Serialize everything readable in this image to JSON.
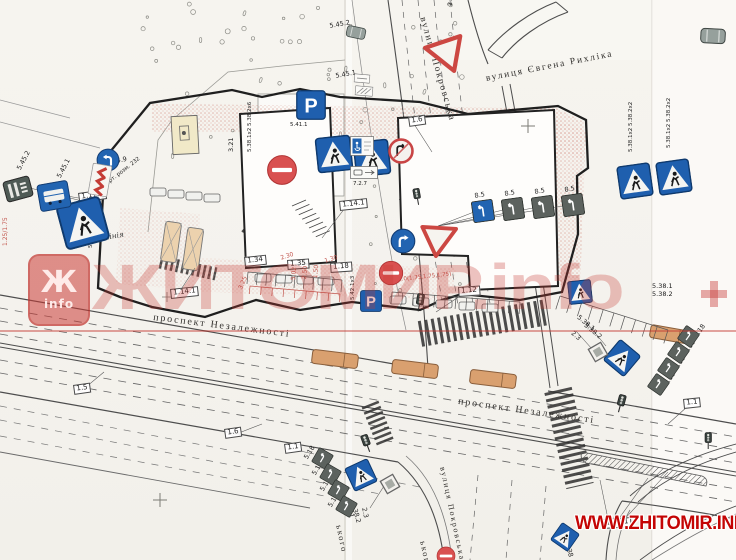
{
  "colors": {
    "paper": "#f5f3ee",
    "line": "#4d4d4d",
    "sign_blue": "#1f5fae",
    "sign_red": "#d95050",
    "bus_orange": "#d9a06f",
    "hatch_pink": "#dba49b",
    "watermark_red": "#c63a34",
    "url_red": "#c40404"
  },
  "watermark": {
    "logo_letter": "Ж",
    "logo_sub": "info",
    "big_text": "ЖИТОМИР.info",
    "url_text": "WWW.ZHITOMIR.INFO"
  },
  "signs_config": {
    "parking_letter": "P"
  },
  "streets": [
    {
      "t": "проспект Незалежності",
      "x": 154,
      "y": 312,
      "r": 7,
      "fs": 10
    },
    {
      "t": "проспект Незалежності",
      "x": 459,
      "y": 396,
      "r": 8,
      "fs": 10
    },
    {
      "t": "вулиця Покровська",
      "x": 427,
      "y": 16,
      "r": 74,
      "fs": 9.5
    },
    {
      "t": "вулиця Покровська",
      "x": 447,
      "y": 466,
      "r": 78,
      "fs": 8
    },
    {
      "t": "вулиця Євгена Рихліка",
      "x": 485,
      "y": 74,
      "r": -11,
      "fs": 9.5
    },
    {
      "t": "ького",
      "x": 344,
      "y": 524,
      "r": 78,
      "fs": 8.5
    },
    {
      "t": "ького",
      "x": 428,
      "y": 540,
      "r": 78,
      "fs": 8.5
    }
  ],
  "labels": [
    {
      "t": "1.17.1",
      "x": 78,
      "y": 193,
      "r": -8,
      "c": "box"
    },
    {
      "t": "5.45.2",
      "x": 16,
      "y": 168,
      "r": -62
    },
    {
      "t": "5.45.1",
      "x": 56,
      "y": 176,
      "r": -62
    },
    {
      "t": "4.9",
      "x": 116,
      "y": 158,
      "r": -12
    },
    {
      "t": "Верт. розм. 232",
      "x": 102,
      "y": 184,
      "r": -38,
      "fs": 5.5
    },
    {
      "t": "5.38.1х2 5.38.2х2",
      "x": 88,
      "y": 248,
      "r": -90,
      "fs": 5.5
    },
    {
      "t": "червона лінія",
      "x": 70,
      "y": 240,
      "r": -10,
      "c": "script"
    },
    {
      "t": "3.21",
      "x": 228,
      "y": 152,
      "r": -90
    },
    {
      "t": "5.38.1х2 5.38.2х6",
      "x": 247,
      "y": 152,
      "r": -90,
      "fs": 5.5
    },
    {
      "t": "5.41.1",
      "x": 290,
      "y": 122,
      "r": 0,
      "fs": 5.5
    },
    {
      "t": "7.17",
      "x": 355,
      "y": 158,
      "r": 0,
      "fs": 5.5
    },
    {
      "t": "7.2.7",
      "x": 353,
      "y": 181,
      "r": 0,
      "fs": 5.5
    },
    {
      "t": "1.6",
      "x": 408,
      "y": 117,
      "r": -8,
      "c": "box"
    },
    {
      "t": "2.1",
      "x": 447,
      "y": 6,
      "r": -90
    },
    {
      "t": "1.34",
      "x": 244,
      "y": 257,
      "r": -6,
      "c": "box"
    },
    {
      "t": "1.35",
      "x": 287,
      "y": 260,
      "r": -4,
      "c": "box"
    },
    {
      "t": "1.18",
      "x": 330,
      "y": 263,
      "r": -4,
      "c": "box"
    },
    {
      "t": "1.14.1",
      "x": 170,
      "y": 289,
      "r": -6,
      "c": "box"
    },
    {
      "t": "1.14.1",
      "x": 339,
      "y": 201,
      "r": -6,
      "c": "box"
    },
    {
      "t": "1.12",
      "x": 458,
      "y": 287,
      "r": -4,
      "c": "box"
    },
    {
      "t": "2.1",
      "x": 404,
      "y": 244,
      "r": -80
    },
    {
      "t": "1.0(1.75,1.75,1.75)",
      "x": 398,
      "y": 277,
      "r": -6,
      "c": "red",
      "fs": 5.5
    },
    {
      "t": "5.02",
      "x": 291,
      "y": 280,
      "r": -85,
      "c": "red"
    },
    {
      "t": "2.50",
      "x": 302,
      "y": 279,
      "r": -85,
      "c": "red"
    },
    {
      "t": "1.50",
      "x": 313,
      "y": 278,
      "r": -85,
      "c": "red"
    },
    {
      "t": "2.30",
      "x": 280,
      "y": 256,
      "r": -18,
      "c": "red"
    },
    {
      "t": "1.30",
      "x": 324,
      "y": 259,
      "r": -18,
      "c": "red"
    },
    {
      "t": "3.25",
      "x": 238,
      "y": 288,
      "r": -65,
      "c": "red"
    },
    {
      "t": "1.25/1.75",
      "x": 3,
      "y": 246,
      "r": -90,
      "c": "red"
    },
    {
      "t": "5.42.1х3",
      "x": 350,
      "y": 300,
      "r": -90,
      "fs": 5.5
    },
    {
      "t": "8.5",
      "x": 474,
      "y": 193,
      "r": -10
    },
    {
      "t": "8.5",
      "x": 504,
      "y": 191,
      "r": -10
    },
    {
      "t": "8.5",
      "x": 534,
      "y": 189,
      "r": -10
    },
    {
      "t": "8.5",
      "x": 564,
      "y": 187,
      "r": -10
    },
    {
      "t": "5.38.1х2 5.38.2х2",
      "x": 628,
      "y": 152,
      "r": -90,
      "fs": 5.5
    },
    {
      "t": "5.38.1х2 5.38.2х2",
      "x": 666,
      "y": 148,
      "r": -90,
      "fs": 5.5
    },
    {
      "t": "5.38.1",
      "x": 652,
      "y": 283,
      "r": 0
    },
    {
      "t": "5.38.2",
      "x": 652,
      "y": 291,
      "r": 0
    },
    {
      "t": "2.3",
      "x": 574,
      "y": 330,
      "r": 40
    },
    {
      "t": "5.38.1",
      "x": 580,
      "y": 314,
      "r": 40
    },
    {
      "t": "5.38.2",
      "x": 587,
      "y": 322,
      "r": 40
    },
    {
      "t": "5.18",
      "x": 303,
      "y": 457,
      "r": -58
    },
    {
      "t": "5.18",
      "x": 311,
      "y": 473,
      "r": -58
    },
    {
      "t": "5.18",
      "x": 319,
      "y": 489,
      "r": -58
    },
    {
      "t": "5.18",
      "x": 327,
      "y": 505,
      "r": -58
    },
    {
      "t": "5.18",
      "x": 663,
      "y": 383,
      "r": -55
    },
    {
      "t": "5.18",
      "x": 673,
      "y": 367,
      "r": -55
    },
    {
      "t": "5.18",
      "x": 683,
      "y": 351,
      "r": -55
    },
    {
      "t": "5.18",
      "x": 693,
      "y": 335,
      "r": -55
    },
    {
      "t": "2.3",
      "x": 367,
      "y": 507,
      "r": 78
    },
    {
      "t": "5.38.1",
      "x": 349,
      "y": 497,
      "r": 74
    },
    {
      "t": "5.38.2",
      "x": 356,
      "y": 502,
      "r": 74
    },
    {
      "t": "5.38",
      "x": 570,
      "y": 542,
      "r": 74
    },
    {
      "t": "1.6",
      "x": 224,
      "y": 429,
      "r": -8,
      "c": "box"
    },
    {
      "t": "1.1",
      "x": 284,
      "y": 444,
      "r": -8,
      "c": "box"
    },
    {
      "t": "1.5",
      "x": 73,
      "y": 385,
      "r": -8,
      "c": "box"
    },
    {
      "t": "1.1",
      "x": 683,
      "y": 399,
      "r": -6,
      "c": "box"
    },
    {
      "t": "1.16.1",
      "x": 603,
      "y": 519,
      "r": -4,
      "c": "box"
    },
    {
      "t": "5.45.2",
      "x": 329,
      "y": 23,
      "r": -10
    },
    {
      "t": "5.45.1",
      "x": 335,
      "y": 73,
      "r": -10
    }
  ],
  "signs": [
    {
      "type": "ped",
      "x": 60,
      "y": 200,
      "s": 46,
      "rot": -15
    },
    {
      "type": "ped",
      "x": 316,
      "y": 136,
      "s": 36,
      "rot": -6
    },
    {
      "type": "ped",
      "x": 354,
      "y": 140,
      "s": 36,
      "rot": -6
    },
    {
      "type": "ped",
      "x": 618,
      "y": 164,
      "s": 34,
      "rot": -8
    },
    {
      "type": "ped",
      "x": 657,
      "y": 160,
      "s": 34,
      "rot": -8
    },
    {
      "type": "ped",
      "x": 568,
      "y": 280,
      "s": 24,
      "rot": -6
    },
    {
      "type": "ped",
      "x": 608,
      "y": 344,
      "s": 28,
      "rot": 40
    },
    {
      "type": "ped",
      "x": 348,
      "y": 462,
      "s": 26,
      "rot": -25
    },
    {
      "type": "ped",
      "x": 554,
      "y": 526,
      "s": 22,
      "rot": 35
    },
    {
      "type": "parking",
      "x": 296,
      "y": 90,
      "s": 30,
      "rot": 0
    },
    {
      "type": "parking",
      "x": 360,
      "y": 290,
      "s": 22,
      "rot": 0
    },
    {
      "type": "noentry",
      "x": 266,
      "y": 154,
      "s": 32,
      "rot": 0
    },
    {
      "type": "noentry",
      "x": 378,
      "y": 260,
      "s": 26,
      "rot": 0
    },
    {
      "type": "noentry",
      "x": 436,
      "y": 546,
      "s": 20,
      "rot": 0
    },
    {
      "type": "noturn",
      "x": 388,
      "y": 138,
      "s": 26,
      "rot": 0
    },
    {
      "type": "mandatory",
      "x": 96,
      "y": 148,
      "s": 24,
      "rot": 0,
      "dir": "left"
    },
    {
      "type": "mandatory",
      "x": 390,
      "y": 228,
      "s": 26,
      "rot": 0,
      "dir": "right"
    },
    {
      "type": "chevron",
      "x": 90,
      "y": 164,
      "w": 20,
      "h": 32,
      "rot": 10
    },
    {
      "type": "yield",
      "x": 420,
      "y": 28,
      "s": 46,
      "rot": 100
    },
    {
      "type": "yield",
      "x": 420,
      "y": 215,
      "s": 42,
      "rot": -115
    },
    {
      "type": "diamond",
      "x": 586,
      "y": 340,
      "s": 24,
      "rot": 15
    },
    {
      "type": "diamond",
      "x": 378,
      "y": 472,
      "s": 24,
      "rot": 15
    },
    {
      "type": "lane",
      "x": 472,
      "y": 200,
      "s": 22,
      "rot": -8,
      "variant": "blue"
    },
    {
      "type": "lane",
      "x": 502,
      "y": 198,
      "s": 22,
      "rot": -8,
      "variant": "dark"
    },
    {
      "type": "lane",
      "x": 532,
      "y": 196,
      "s": 22,
      "rot": -8,
      "variant": "dark"
    },
    {
      "type": "lane",
      "x": 562,
      "y": 194,
      "s": 22,
      "rot": -8,
      "variant": "dark"
    },
    {
      "type": "lane",
      "x": 314,
      "y": 450,
      "s": 17,
      "rot": 30,
      "variant": "dark"
    },
    {
      "type": "lane",
      "x": 322,
      "y": 466,
      "s": 17,
      "rot": 30,
      "variant": "dark"
    },
    {
      "type": "lane",
      "x": 330,
      "y": 482,
      "s": 17,
      "rot": 30,
      "variant": "dark"
    },
    {
      "type": "lane",
      "x": 338,
      "y": 498,
      "s": 17,
      "rot": 30,
      "variant": "dark"
    },
    {
      "type": "lane",
      "x": 650,
      "y": 376,
      "s": 17,
      "rot": 35,
      "variant": "dark"
    },
    {
      "type": "lane",
      "x": 660,
      "y": 360,
      "s": 17,
      "rot": 35,
      "variant": "dark"
    },
    {
      "type": "lane",
      "x": 670,
      "y": 344,
      "s": 17,
      "rot": 35,
      "variant": "dark"
    },
    {
      "type": "lane",
      "x": 680,
      "y": 328,
      "s": 17,
      "rot": 35,
      "variant": "dark"
    },
    {
      "type": "busstop-dark",
      "x": 4,
      "y": 178,
      "w": 28,
      "h": 22,
      "rot": -15
    },
    {
      "type": "busstop-blue",
      "x": 38,
      "y": 182,
      "w": 32,
      "h": 28,
      "rot": -10
    },
    {
      "type": "car-gray",
      "x": 346,
      "y": 26,
      "w": 20,
      "h": 13,
      "rot": 12
    },
    {
      "type": "car-gray",
      "x": 700,
      "y": 28,
      "w": 26,
      "h": 16,
      "rot": 3
    },
    {
      "type": "plate",
      "x": 354,
      "y": 74,
      "w": 16,
      "h": 9,
      "rot": 5
    },
    {
      "type": "shelter",
      "x": 355,
      "y": 86,
      "w": 18,
      "h": 10,
      "rot": 5
    },
    {
      "type": "disabled",
      "x": 350,
      "y": 136,
      "w": 24,
      "h": 20,
      "rot": 0
    },
    {
      "type": "plate-wide",
      "x": 350,
      "y": 166,
      "w": 28,
      "h": 13,
      "rot": 0
    },
    {
      "type": "tl",
      "x": 411,
      "y": 188,
      "s": 12,
      "rot": -10
    },
    {
      "type": "tl",
      "x": 413,
      "y": 293,
      "s": 13,
      "rot": 10
    },
    {
      "type": "tl",
      "x": 360,
      "y": 434,
      "s": 13,
      "rot": -20
    },
    {
      "type": "tl",
      "x": 614,
      "y": 394,
      "s": 13,
      "rot": 15
    },
    {
      "type": "tl",
      "x": 702,
      "y": 432,
      "s": 12,
      "rot": 0
    }
  ]
}
